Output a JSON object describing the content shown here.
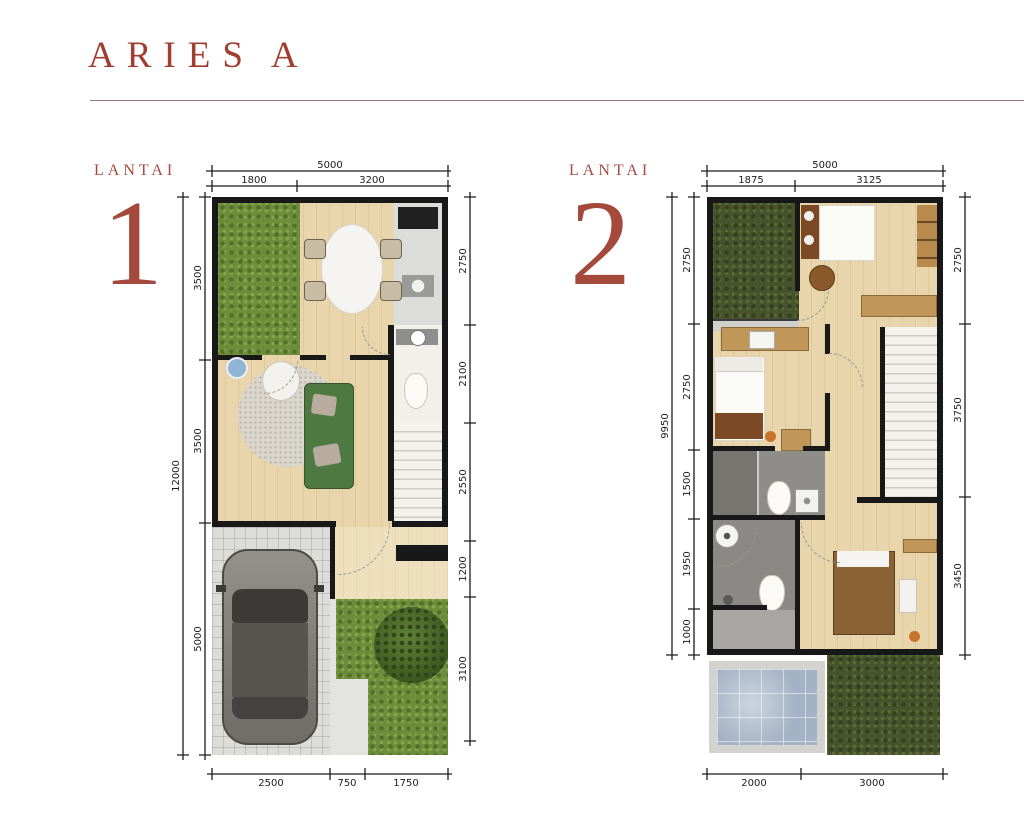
{
  "page": {
    "title": {
      "word1": "ARIES",
      "word2": "A"
    },
    "colors": {
      "accent": "#A5493C",
      "wall": "#181818"
    }
  },
  "floor1": {
    "label": "LANTAI",
    "number": "1",
    "dims": {
      "top_total": "5000",
      "top_segments": [
        "1800",
        "3200"
      ],
      "left_total": "12000",
      "left_segments": [
        "3500",
        "3500",
        "5000"
      ],
      "right_segments": [
        "2750",
        "2100",
        "2550",
        "1200",
        "3100"
      ],
      "bottom_segments": [
        "2500",
        "750",
        "1750"
      ]
    }
  },
  "floor2": {
    "label": "LANTAI",
    "number": "2",
    "dims": {
      "top_total": "5000",
      "top_segments": [
        "1875",
        "3125"
      ],
      "left_total": "9950",
      "left_segments": [
        "2750",
        "2750",
        "1500",
        "1950",
        "1000"
      ],
      "right_segments": [
        "2750",
        "3750",
        "3450"
      ],
      "bottom_segments": [
        "2000",
        "3000"
      ]
    }
  }
}
